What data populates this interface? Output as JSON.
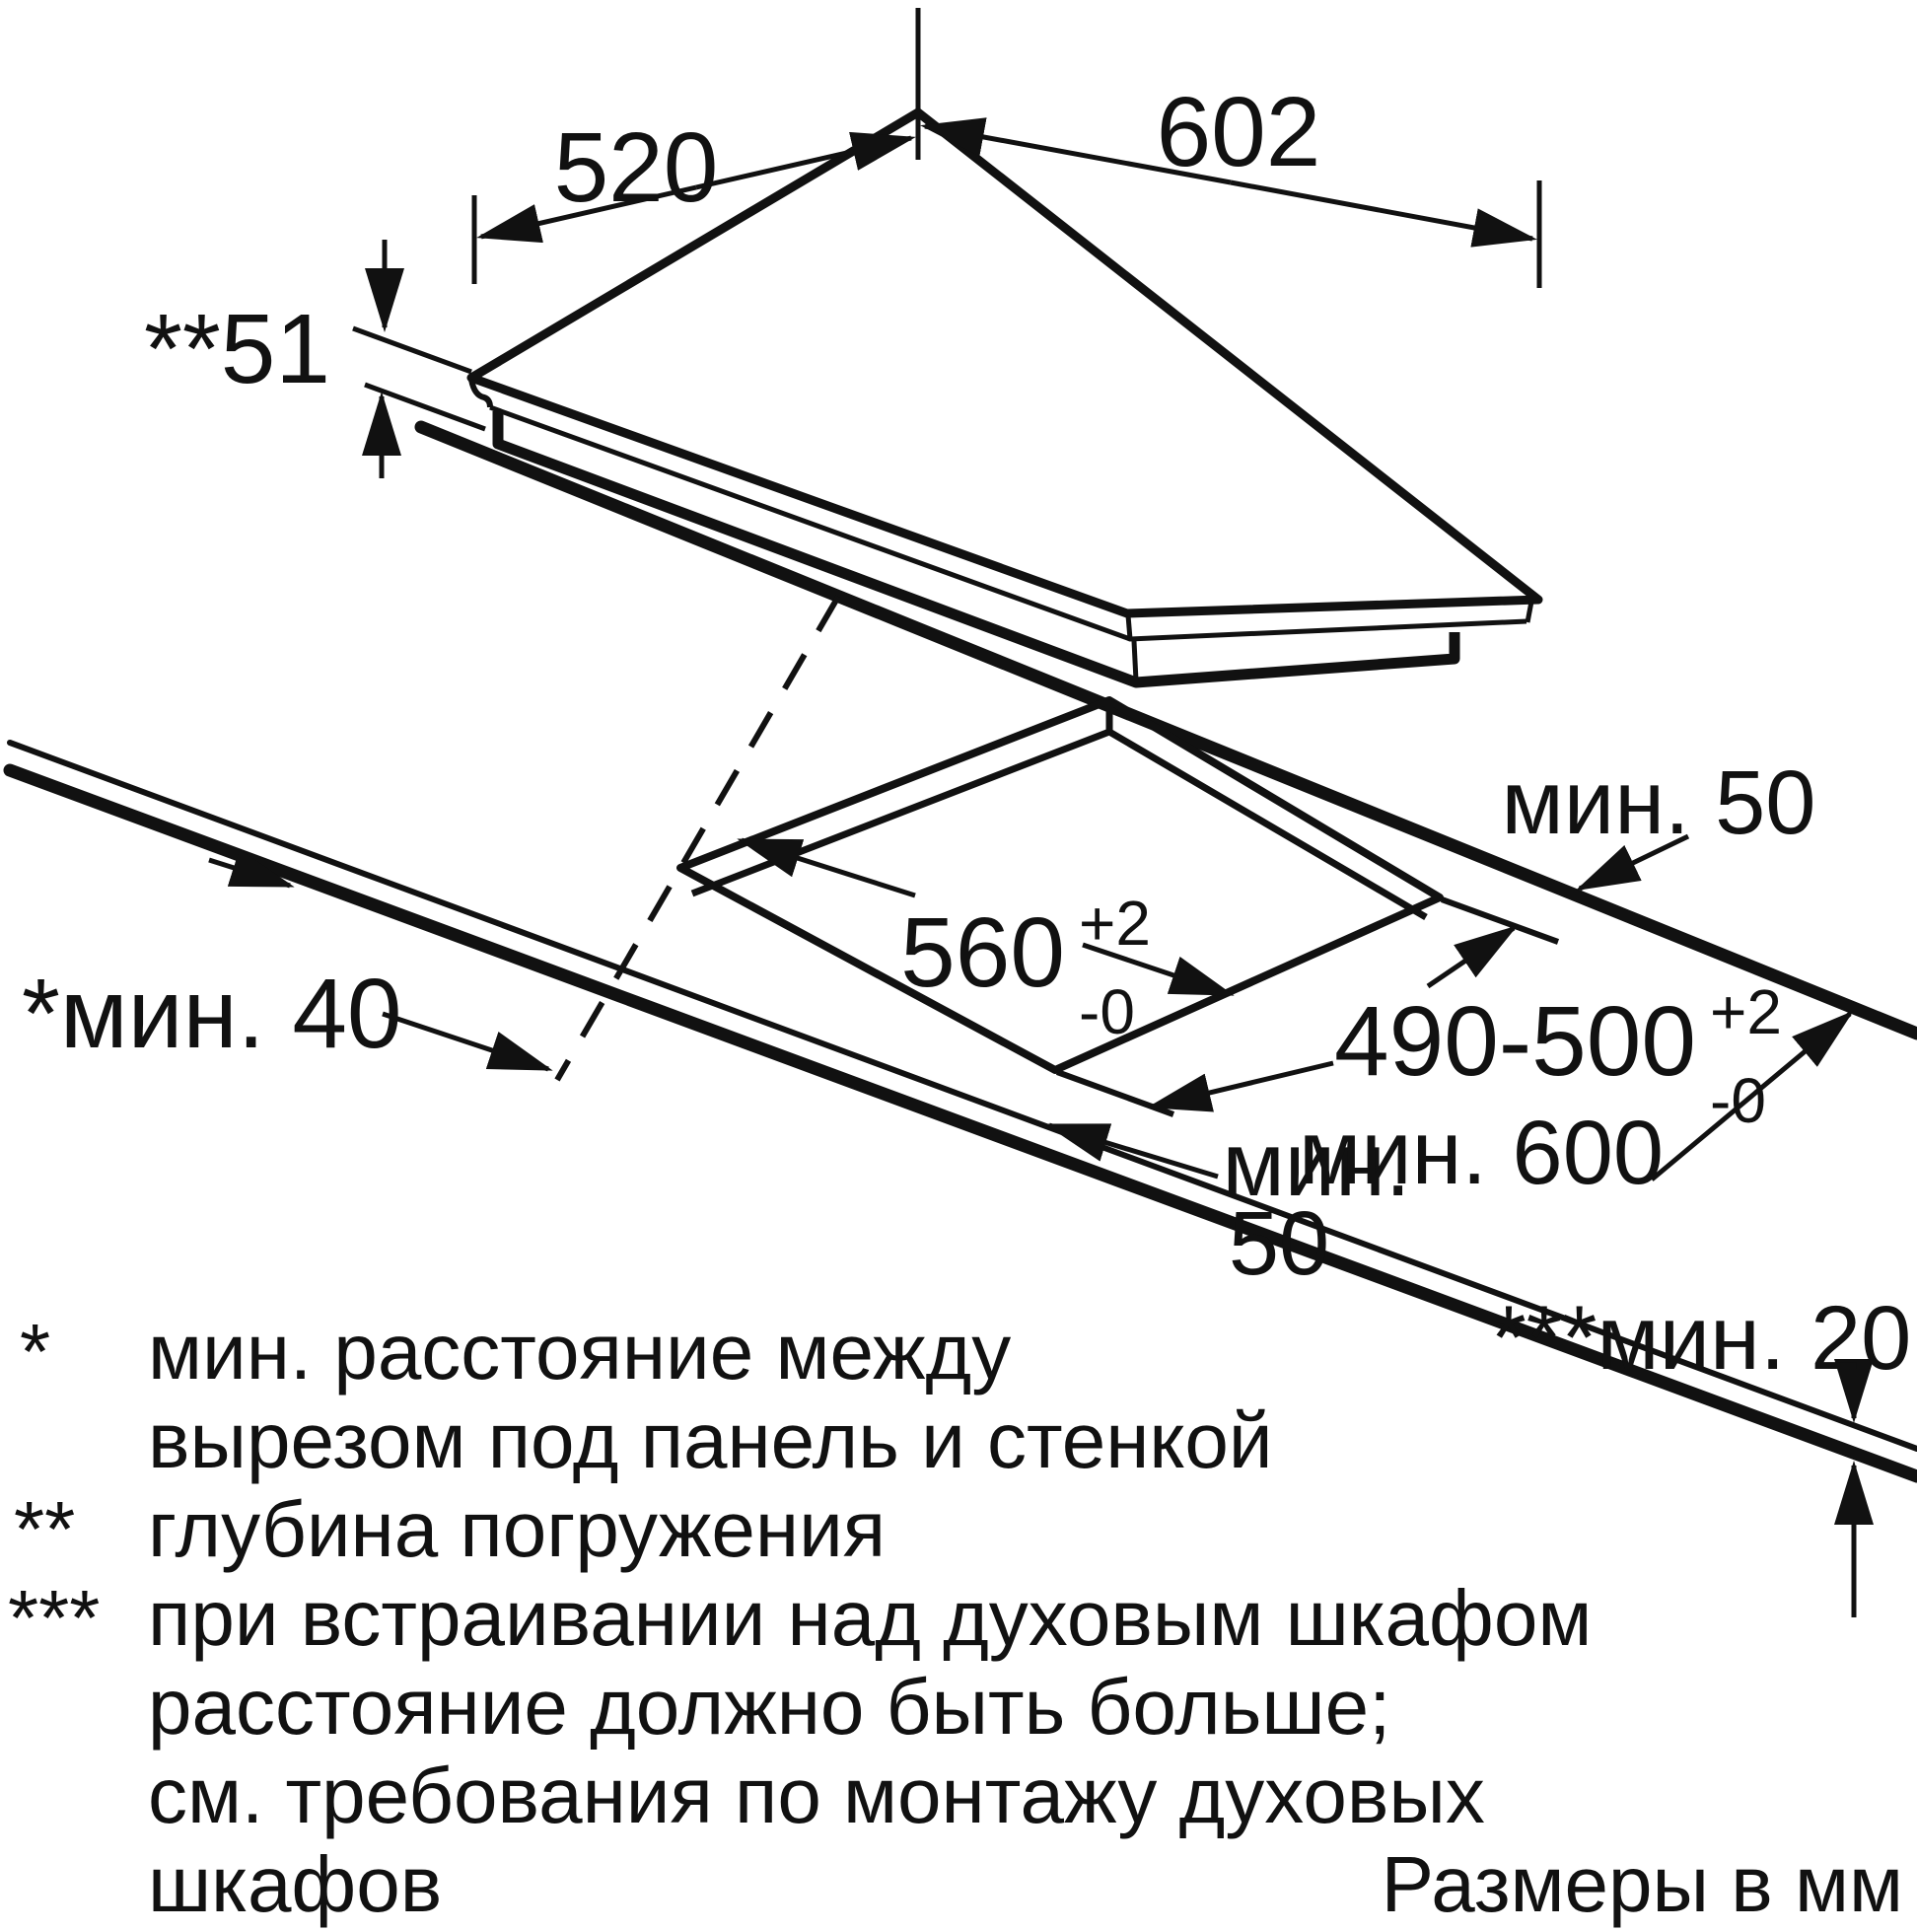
{
  "panel": {
    "width_label": "602",
    "depth_label": "520",
    "immersion_label": "**51"
  },
  "cutout": {
    "width_value": "560",
    "width_tol_plus": "+2",
    "width_tol_minus": "-0",
    "depth_value": "490-500",
    "depth_tol_plus": "+2",
    "depth_tol_minus": "-0"
  },
  "clearances": {
    "min50_right": "мин. 50",
    "min50_bottom_line1": "мин.",
    "min50_bottom_line2": "50",
    "min40_left": "*мин. 40",
    "min600": "мин. 600",
    "min20": "***мин. 20"
  },
  "footnote_rows": [
    {
      "marker": "*",
      "text": "мин. расстояние между"
    },
    {
      "marker": "",
      "text": "вырезом под панель и стенкой"
    },
    {
      "marker": "**",
      "text": "глубина погружения"
    },
    {
      "marker": "***",
      "text": "при встраивании над духовым шкафом"
    },
    {
      "marker": "",
      "text": "расстояние должно быть больше;"
    },
    {
      "marker": "",
      "text": "см. требования по монтажу духовых"
    },
    {
      "marker": "",
      "text": "шкафов"
    }
  ],
  "units_note": "Размеры в мм",
  "colors": {
    "ink": "#111111",
    "paper": "#ffffff"
  }
}
